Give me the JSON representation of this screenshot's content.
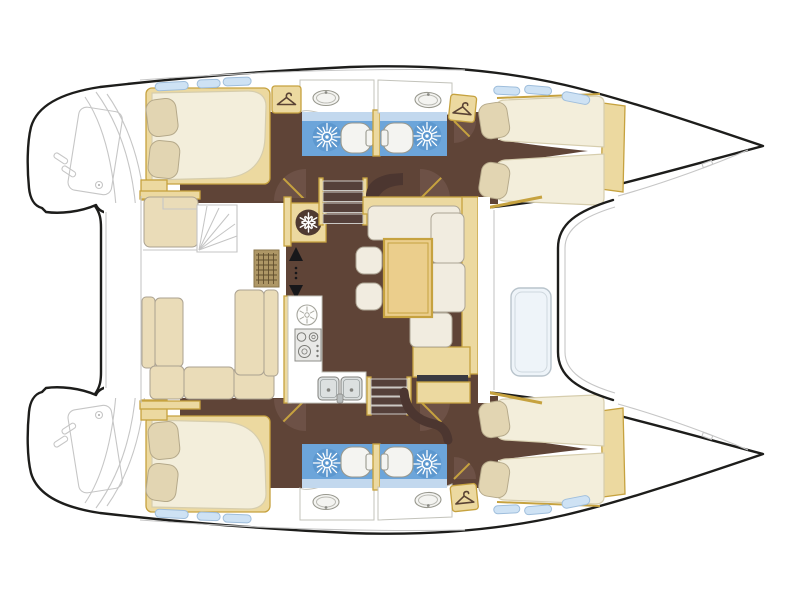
{
  "page": {
    "title": "",
    "background": "#ffffff"
  },
  "diagram": {
    "type": "floor-plan",
    "subject": "catamaran-yacht-deck-plan",
    "orientation": {
      "bow": "right",
      "stern": "left"
    },
    "colors": {
      "hull_outline": "#1d1d1b",
      "detail_gray": "#c6c6c6",
      "floor_brown": "#5f4437",
      "floor_brown_dark": "#4c3630",
      "door_arc": "#6d5146",
      "wood_tan": "#ecd9a0",
      "wood_tan_border": "#c6a23f",
      "table_wood": "#ebce8c",
      "mattress": "#f3eedb",
      "pillow": "#e2d5b2",
      "cushion_cream": "#f1ece0",
      "cushion_border": "#aca493",
      "cockpit_cushion": "#eadcb8",
      "shower_blue": "#6ca5da",
      "shower_blue_light": "#c2d8ee",
      "fixture_white": "#f4f4f1",
      "fixture_border": "#98988e",
      "window_blue": "#cee2f4",
      "window_border": "#9fbedc",
      "steel_gray": "#dce0e0",
      "dark_trim": "#3a3a40",
      "grate_tan": "#ae9766"
    },
    "icons": {
      "shower": "starburst-sun-symbol",
      "refrigerator": "snowflake-in-circle",
      "hanging_locker": "clothes-hanger",
      "galley_vent": "circle-with-radial-spokes",
      "companionway": "up-down-arrows"
    },
    "hull_top": {
      "aft_cabin": {
        "bed": "island-double-bed",
        "pillows": 2
      },
      "heads": [
        {
          "fixtures": [
            "shower",
            "toilet",
            "washbasin",
            "hanging-locker"
          ]
        },
        {
          "fixtures": [
            "shower",
            "toilet",
            "washbasin",
            "hanging-locker"
          ]
        }
      ],
      "forward_cabin": {
        "bed": "v-berth-double",
        "pillows": 2
      }
    },
    "hull_bottom": {
      "aft_cabin": {
        "bed": "island-double-bed",
        "pillows": 2
      },
      "heads": [
        {
          "fixtures": [
            "shower",
            "toilet",
            "washbasin"
          ]
        },
        {
          "fixtures": [
            "shower",
            "toilet",
            "washbasin",
            "hanging-locker"
          ]
        }
      ],
      "forward_cabin": {
        "bed": "v-berth-double",
        "pillows": 2
      }
    },
    "salon": {
      "galley": [
        "three-burner-stove",
        "double-sink",
        "refrigerator",
        "round-vent"
      ],
      "dinette": {
        "tables": 1,
        "settee_cushions": 4,
        "stools": 2
      },
      "companionways": [
        "stairs-to-top-hull",
        "stairs-to-bottom-hull"
      ],
      "entry_marker": "up-down-arrows"
    },
    "cockpit": {
      "bench": "u-shaped",
      "bench_cushions": 7,
      "helm_seat": 1,
      "helm_steps": 1,
      "floor_grating": 1
    },
    "deck": {
      "foredeck_hatch": 1,
      "transom_platforms": 2,
      "windows": 12,
      "stern_cleats": 4
    }
  }
}
